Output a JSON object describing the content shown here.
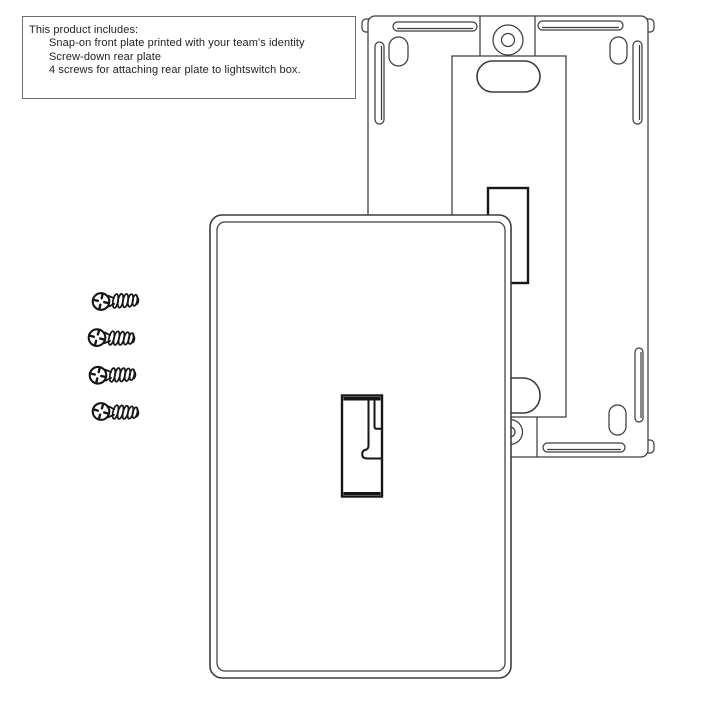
{
  "colors": {
    "bg-color": "#ffffff",
    "line-color": "#3d3d3d",
    "bold-color": "#161616",
    "text-color": "#222222",
    "box-border-color": "#6e6e6e"
  },
  "info_box": {
    "title": "This product includes:",
    "items": [
      "Snap-on front plate printed with your team's identity",
      "Screw-down rear plate",
      "4 screws for attaching rear plate to lightswitch box."
    ]
  },
  "diagram": {
    "screw_count": 4,
    "parts": [
      "rear-plate",
      "front-plate",
      "screws"
    ]
  }
}
